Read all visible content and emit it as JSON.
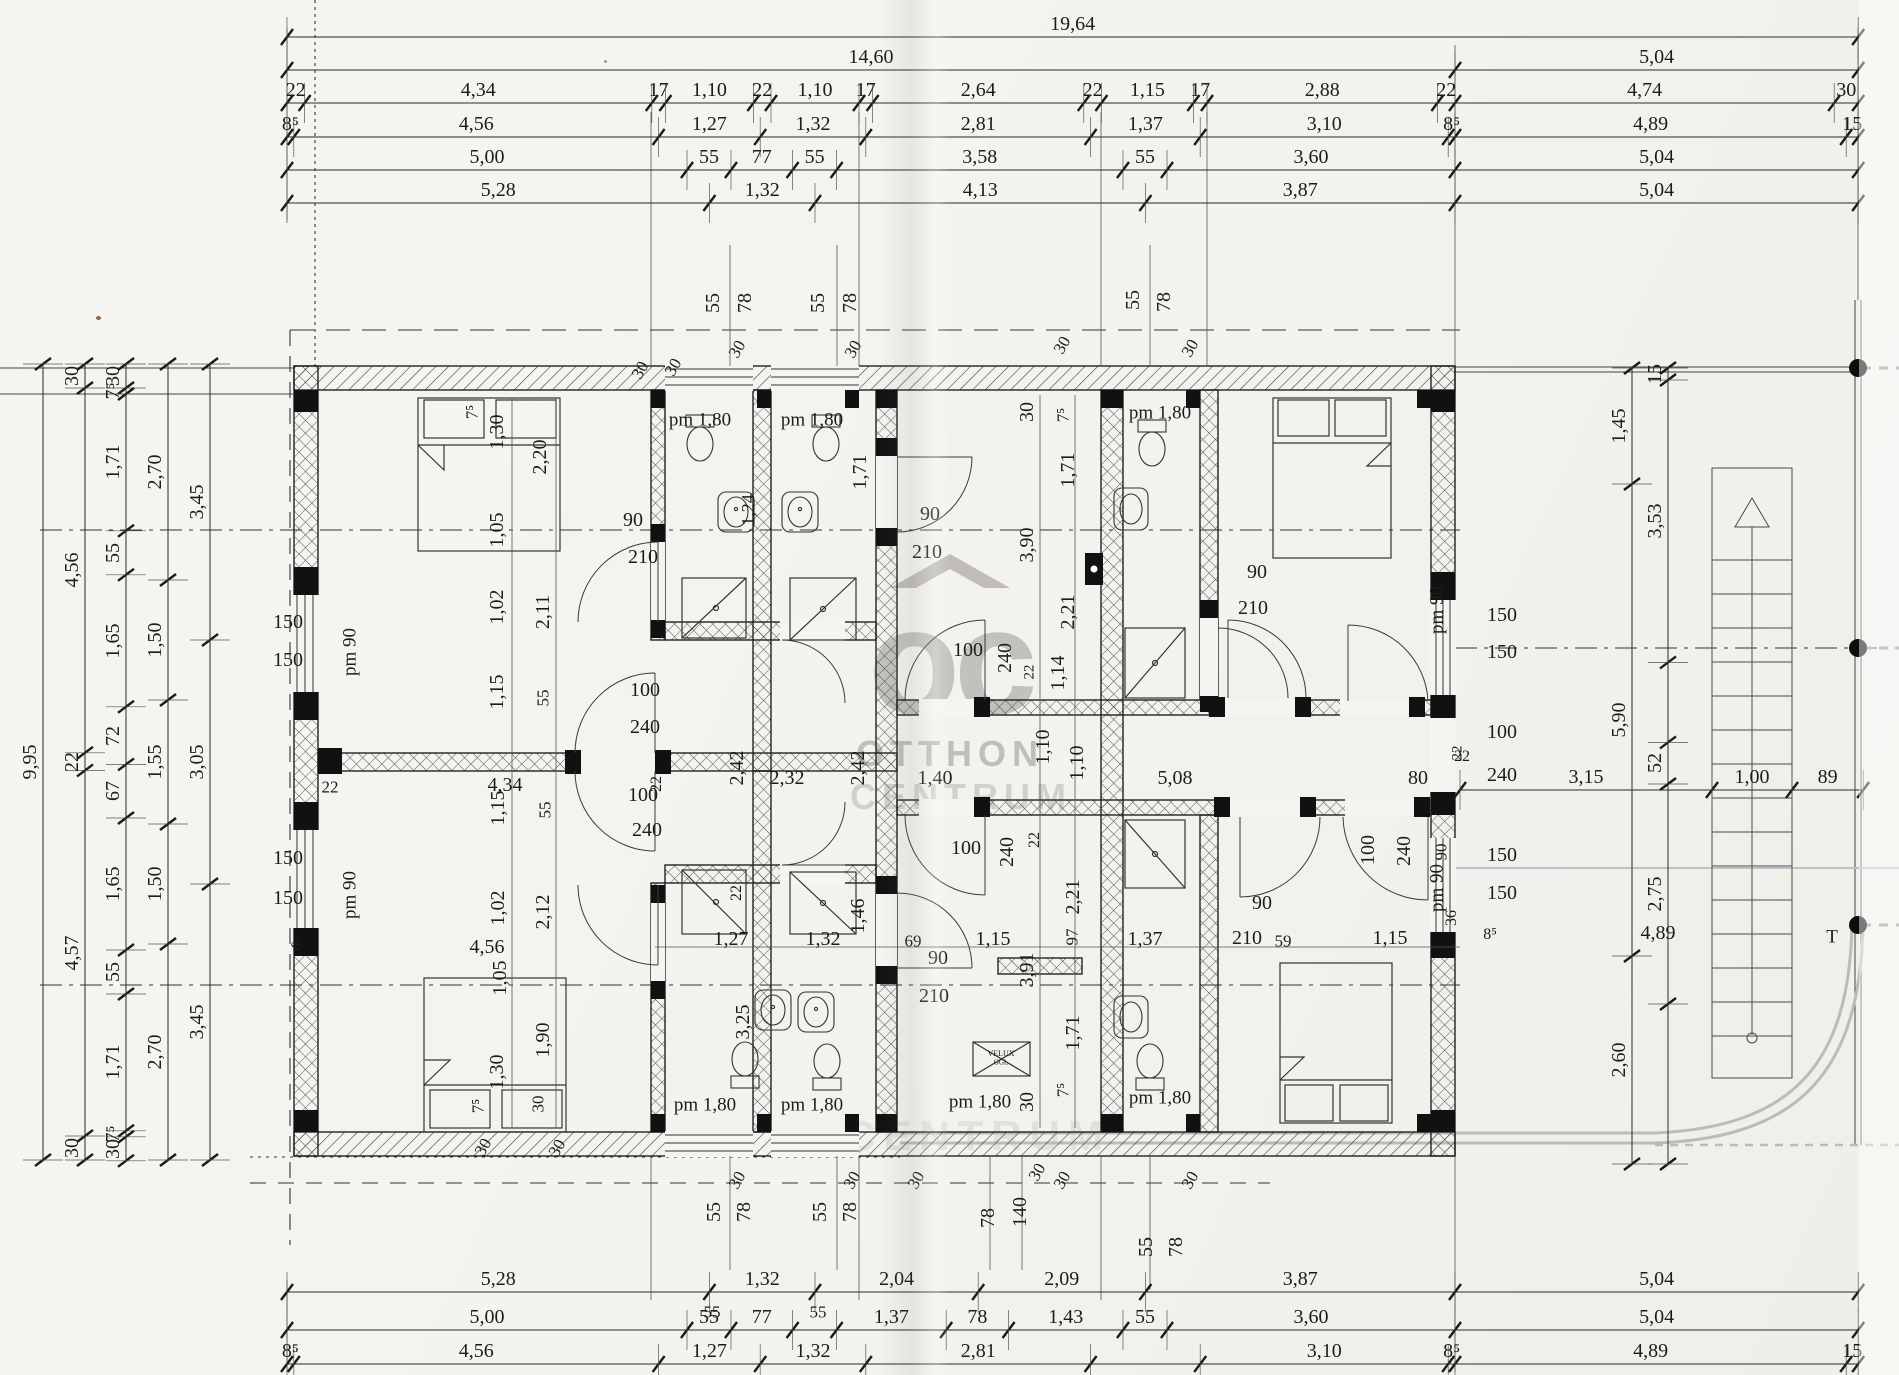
{
  "watermark": {
    "logo": "oc",
    "line1": "OTTHON",
    "line2": "CENTRUM",
    "line2_echo": "CENTRUM",
    "color": "#b5b3af"
  },
  "scale_px_per_m": 80,
  "dim_chains": [
    {
      "o": "h",
      "x": 287,
      "y": 37,
      "segs": [
        [
          19.64,
          "19,64"
        ]
      ]
    },
    {
      "o": "h",
      "x": 287,
      "y": 70,
      "segs": [
        [
          14.6,
          "14,60"
        ],
        [
          5.04,
          "5,04"
        ]
      ]
    },
    {
      "o": "h",
      "x": 287,
      "y": 103,
      "segs": [
        [
          0.22,
          "22"
        ],
        [
          4.34,
          "4,34"
        ],
        [
          0.17,
          "17"
        ],
        [
          1.1,
          "1,10"
        ],
        [
          0.22,
          "22"
        ],
        [
          1.1,
          "1,10"
        ],
        [
          0.17,
          "17"
        ],
        [
          2.64,
          "2,64"
        ],
        [
          0.22,
          "22"
        ],
        [
          1.15,
          "1,15"
        ],
        [
          0.17,
          "17"
        ],
        [
          2.88,
          "2,88"
        ],
        [
          0.22,
          "22"
        ],
        [
          4.74,
          "4,74"
        ],
        [
          0.3,
          "30"
        ]
      ]
    },
    {
      "o": "h",
      "x": 287,
      "y": 137,
      "segs": [
        [
          0.085,
          "8⁵"
        ],
        [
          4.56,
          "4,56"
        ],
        [
          1.27,
          "1,27"
        ],
        [
          1.32,
          "1,32"
        ],
        [
          2.81,
          "2,81"
        ],
        [
          1.37,
          "1,37"
        ],
        [
          3.1,
          "3,10"
        ],
        [
          0.085,
          "8⁵"
        ],
        [
          4.89,
          "4,89"
        ],
        [
          0.15,
          "15"
        ]
      ]
    },
    {
      "o": "h",
      "x": 287,
      "y": 170,
      "segs": [
        [
          5.0,
          "5,00"
        ],
        [
          0.55,
          "55"
        ],
        [
          0.77,
          "77"
        ],
        [
          0.55,
          "55"
        ],
        [
          3.58,
          "3,58"
        ],
        [
          0.55,
          "55"
        ],
        [
          3.6,
          "3,60"
        ],
        [
          5.04,
          "5,04"
        ]
      ]
    },
    {
      "o": "h",
      "x": 287,
      "y": 203,
      "segs": [
        [
          5.28,
          "5,28"
        ],
        [
          1.32,
          "1,32"
        ],
        [
          4.13,
          "4,13"
        ],
        [
          3.87,
          "3,87"
        ],
        [
          5.04,
          "5,04"
        ]
      ]
    },
    {
      "o": "h",
      "x": 287,
      "y": 1292,
      "segs": [
        [
          5.28,
          "5,28"
        ],
        [
          1.32,
          "1,32"
        ],
        [
          2.04,
          "2,04"
        ],
        [
          2.09,
          "2,09"
        ],
        [
          3.87,
          "3,87"
        ],
        [
          5.04,
          "5,04"
        ]
      ]
    },
    {
      "o": "h",
      "x": 287,
      "y": 1330,
      "segs": [
        [
          5.0,
          "5,00"
        ],
        [
          0.55,
          "55"
        ],
        [
          0.77,
          "77"
        ],
        [
          0.55,
          ""
        ],
        [
          1.37,
          "1,37"
        ],
        [
          0.78,
          "78"
        ],
        [
          1.43,
          "1,43"
        ],
        [
          0.55,
          "55"
        ],
        [
          3.6,
          "3,60"
        ],
        [
          5.04,
          "5,04"
        ]
      ]
    },
    {
      "o": "h",
      "x": 287,
      "y": 1364,
      "segs": [
        [
          0.085,
          "8⁵"
        ],
        [
          4.56,
          "4,56"
        ],
        [
          1.27,
          "1,27"
        ],
        [
          1.32,
          "1,32"
        ],
        [
          2.81,
          "2,81"
        ],
        [
          1.37,
          ""
        ],
        [
          3.1,
          "3,10"
        ],
        [
          0.085,
          "8⁵"
        ],
        [
          4.89,
          "4,89"
        ],
        [
          0.15,
          "15"
        ]
      ]
    },
    {
      "o": "v",
      "x": 43,
      "y": 364,
      "segs": [
        [
          9.95,
          "9,95"
        ]
      ]
    },
    {
      "o": "v",
      "x": 85,
      "y": 364,
      "segs": [
        [
          0.3,
          "30"
        ],
        [
          4.56,
          "4,56"
        ],
        [
          0.22,
          "22"
        ],
        [
          4.57,
          "4,57"
        ],
        [
          0.3,
          "30"
        ]
      ]
    },
    {
      "o": "v",
      "x": 126,
      "y": 364,
      "segs": [
        [
          0.3,
          "30"
        ],
        [
          0.075,
          "7⁵"
        ],
        [
          1.71,
          "1,71"
        ],
        [
          0.55,
          "55"
        ],
        [
          1.65,
          "1,65"
        ],
        [
          0.72,
          "72"
        ],
        [
          0.67,
          "67"
        ],
        [
          1.65,
          "1,65"
        ],
        [
          0.55,
          "55"
        ],
        [
          1.71,
          "1,71"
        ],
        [
          0.075,
          "7⁵"
        ],
        [
          0.3,
          "30"
        ]
      ]
    },
    {
      "o": "v",
      "x": 168,
      "y": 364,
      "segs": [
        [
          2.7,
          "2,70"
        ],
        [
          1.5,
          "1,50"
        ],
        [
          1.55,
          "1,55"
        ],
        [
          1.5,
          "1,50"
        ],
        [
          2.7,
          "2,70"
        ]
      ]
    },
    {
      "o": "v",
      "x": 210,
      "y": 364,
      "segs": [
        [
          3.45,
          "3,45"
        ],
        [
          3.05,
          "3,05"
        ],
        [
          3.45,
          "3,45"
        ]
      ]
    },
    {
      "o": "v",
      "x": 1632,
      "y": 368,
      "segs": [
        [
          1.45,
          "1,45"
        ],
        [
          5.9,
          "5,90"
        ],
        [
          2.6,
          "2,60"
        ]
      ]
    },
    {
      "o": "v",
      "x": 1668,
      "y": 368,
      "segs": [
        [
          0.15,
          "15"
        ],
        [
          3.53,
          "3,53"
        ],
        [
          1.0,
          ""
        ],
        [
          0.52,
          "52"
        ],
        [
          2.75,
          "2,75"
        ],
        [
          2.0,
          ""
        ]
      ]
    },
    {
      "o": "h",
      "x": 1460,
      "y": 790,
      "segs": [
        [
          3.15,
          "3,15"
        ],
        [
          1.0,
          "1,00"
        ],
        [
          0.89,
          "89"
        ]
      ]
    }
  ],
  "labels": [
    [
      "55",
      713,
      303,
      -90
    ],
    [
      "78",
      745,
      303,
      -90
    ],
    [
      "55",
      818,
      303,
      -90
    ],
    [
      "78",
      850,
      303,
      -90
    ],
    [
      "55",
      1133,
      300,
      -90
    ],
    [
      "78",
      1164,
      302,
      -90
    ],
    [
      "30",
      640,
      370,
      -60,
      17
    ],
    [
      "30",
      673,
      367,
      -60,
      17
    ],
    [
      "30",
      737,
      349,
      -60,
      17
    ],
    [
      "30",
      853,
      349,
      -60,
      17
    ],
    [
      "30",
      1062,
      345,
      -60,
      17
    ],
    [
      "30",
      1190,
      348,
      -60,
      17
    ],
    [
      "pm 1,80",
      700,
      420,
      0,
      19
    ],
    [
      "pm 1,80",
      812,
      420,
      0,
      19
    ],
    [
      "pm 1,80",
      1160,
      413,
      0,
      19
    ],
    [
      "1,24",
      748,
      510,
      -90,
      18
    ],
    [
      "1,71",
      860,
      472,
      -90
    ],
    [
      "90",
      633,
      520
    ],
    [
      "210",
      643,
      557
    ],
    [
      "7⁵",
      472,
      412,
      -90,
      17
    ],
    [
      "1,30",
      497,
      432,
      -90
    ],
    [
      "2,20",
      540,
      457,
      -90
    ],
    [
      "1,05",
      497,
      530,
      -90
    ],
    [
      "1,02",
      497,
      607,
      -90
    ],
    [
      "2,11",
      543,
      612,
      -90
    ],
    [
      "1,15",
      497,
      692,
      -90
    ],
    [
      "55",
      543,
      698,
      -90,
      17
    ],
    [
      "150",
      288,
      622
    ],
    [
      "150",
      288,
      660
    ],
    [
      "pm 90",
      350,
      652,
      -90,
      19
    ],
    [
      "150",
      288,
      858
    ],
    [
      "150",
      288,
      898
    ],
    [
      "pm 90",
      350,
      895,
      -90,
      19
    ],
    [
      "8⁵",
      299,
      944,
      -60,
      16
    ],
    [
      "22",
      330,
      787,
      0,
      17
    ],
    [
      "4,34",
      505,
      785
    ],
    [
      "100",
      645,
      690
    ],
    [
      "240",
      645,
      727
    ],
    [
      "22",
      657,
      784,
      -90,
      16
    ],
    [
      "100",
      643,
      795
    ],
    [
      "240",
      647,
      830
    ],
    [
      "1,15",
      498,
      808,
      -90
    ],
    [
      "55",
      545,
      810,
      -90,
      17
    ],
    [
      "1,02",
      498,
      908,
      -90
    ],
    [
      "2,12",
      543,
      912,
      -90
    ],
    [
      "1,05",
      500,
      978,
      -90
    ],
    [
      "90",
      930,
      514
    ],
    [
      "210",
      927,
      552
    ],
    [
      "2,42",
      737,
      768,
      -90
    ],
    [
      "2,32",
      787,
      778
    ],
    [
      "2,42",
      858,
      768,
      -90
    ],
    [
      "1,40",
      935,
      778
    ],
    [
      "1,10",
      1043,
      747,
      -90
    ],
    [
      "1,10",
      1077,
      763,
      -90
    ],
    [
      "5,08",
      1175,
      778
    ],
    [
      "30",
      1027,
      412,
      -90
    ],
    [
      "7⁵",
      1063,
      415,
      -90,
      17
    ],
    [
      "1,71",
      1068,
      470,
      -90
    ],
    [
      "3,90",
      1027,
      545,
      -90
    ],
    [
      "2,21",
      1068,
      612,
      -90
    ],
    [
      "1,14",
      1058,
      673,
      -90
    ],
    [
      "22",
      1035,
      840,
      -90,
      16
    ],
    [
      "2,21",
      1073,
      897,
      -90
    ],
    [
      "97",
      1072,
      937,
      -90,
      17
    ],
    [
      "3,91",
      1027,
      970,
      -90
    ],
    [
      "1,71",
      1073,
      1033,
      -90
    ],
    [
      "7⁵",
      1063,
      1090,
      -90,
      17
    ],
    [
      "30",
      1027,
      1102,
      -90
    ],
    [
      "100",
      968,
      650
    ],
    [
      "240",
      1005,
      658,
      -90
    ],
    [
      "22",
      1030,
      672,
      -90,
      15
    ],
    [
      "100",
      966,
      848
    ],
    [
      "240",
      1007,
      852,
      -90
    ],
    [
      "90",
      938,
      958
    ],
    [
      "210",
      934,
      996
    ],
    [
      "4,56",
      487,
      947
    ],
    [
      "1,27",
      731,
      939
    ],
    [
      "1,32",
      823,
      939
    ],
    [
      "69",
      913,
      941,
      0,
      17
    ],
    [
      "1,15",
      993,
      939
    ],
    [
      "1,37",
      1145,
      939
    ],
    [
      "59",
      1283,
      941,
      0,
      17
    ],
    [
      "1,15",
      1390,
      938
    ],
    [
      "36",
      1452,
      918,
      -90,
      16
    ],
    [
      "8⁵",
      1490,
      935,
      0,
      16
    ],
    [
      "4,89",
      1658,
      933
    ],
    [
      "3,25",
      743,
      1022,
      -90
    ],
    [
      "1,46",
      858,
      916,
      -90
    ],
    [
      "22",
      737,
      893,
      -90,
      16
    ],
    [
      "pm 1,80",
      705,
      1105,
      0,
      19
    ],
    [
      "pm 1,80",
      812,
      1105,
      0,
      19
    ],
    [
      "pm 1,80",
      980,
      1102,
      0,
      19
    ],
    [
      "pm 1,80",
      1160,
      1098,
      0,
      19
    ],
    [
      "1,90",
      543,
      1040,
      -90
    ],
    [
      "1,30",
      497,
      1072,
      -90
    ],
    [
      "7⁵",
      478,
      1106,
      -90,
      17
    ],
    [
      "30",
      538,
      1104,
      -90,
      17
    ],
    [
      "30",
      483,
      1147,
      -60,
      17
    ],
    [
      "30",
      557,
      1148,
      -60,
      17
    ],
    [
      "90",
      1257,
      572
    ],
    [
      "210",
      1253,
      608
    ],
    [
      "90",
      1262,
      903
    ],
    [
      "210",
      1247,
      938
    ],
    [
      "80",
      1418,
      778
    ],
    [
      "22",
      1462,
      757,
      0,
      16
    ],
    [
      "100",
      1368,
      850,
      -90
    ],
    [
      "240",
      1404,
      851,
      -90
    ],
    [
      "90",
      1441,
      852,
      -90,
      17
    ],
    [
      "pm 90",
      1437,
      610,
      -90,
      19
    ],
    [
      "150",
      1502,
      615
    ],
    [
      "150",
      1502,
      652
    ],
    [
      "100",
      1502,
      732
    ],
    [
      "22",
      1458,
      753,
      -90,
      15
    ],
    [
      "240",
      1502,
      775
    ],
    [
      "150",
      1502,
      855
    ],
    [
      "150",
      1502,
      893
    ],
    [
      "pm 90",
      1437,
      888,
      -90,
      19
    ],
    [
      "55",
      714,
      1212,
      -90
    ],
    [
      "78",
      744,
      1212,
      -90
    ],
    [
      "55",
      820,
      1212,
      -90
    ],
    [
      "78",
      850,
      1212,
      -90
    ],
    [
      "78",
      988,
      1218,
      -90
    ],
    [
      "140",
      1020,
      1212,
      -90
    ],
    [
      "55",
      1146,
      1247,
      -90
    ],
    [
      "78",
      1176,
      1247,
      -90
    ],
    [
      "30",
      737,
      1180,
      -60,
      17
    ],
    [
      "30",
      852,
      1180,
      -60,
      17
    ],
    [
      "30",
      916,
      1180,
      -60,
      17
    ],
    [
      "30",
      1037,
      1172,
      -60,
      17
    ],
    [
      "30",
      1062,
      1180,
      -60,
      17
    ],
    [
      "30",
      1190,
      1180,
      -60,
      17
    ],
    [
      "55",
      712,
      1312,
      0,
      17
    ],
    [
      "55",
      818,
      1312,
      0,
      17
    ],
    [
      "VELUX",
      1001,
      1054,
      0,
      8
    ],
    [
      "GGL",
      1001,
      1063,
      0,
      7
    ],
    [
      "T",
      1832,
      937,
      0,
      19
    ]
  ]
}
